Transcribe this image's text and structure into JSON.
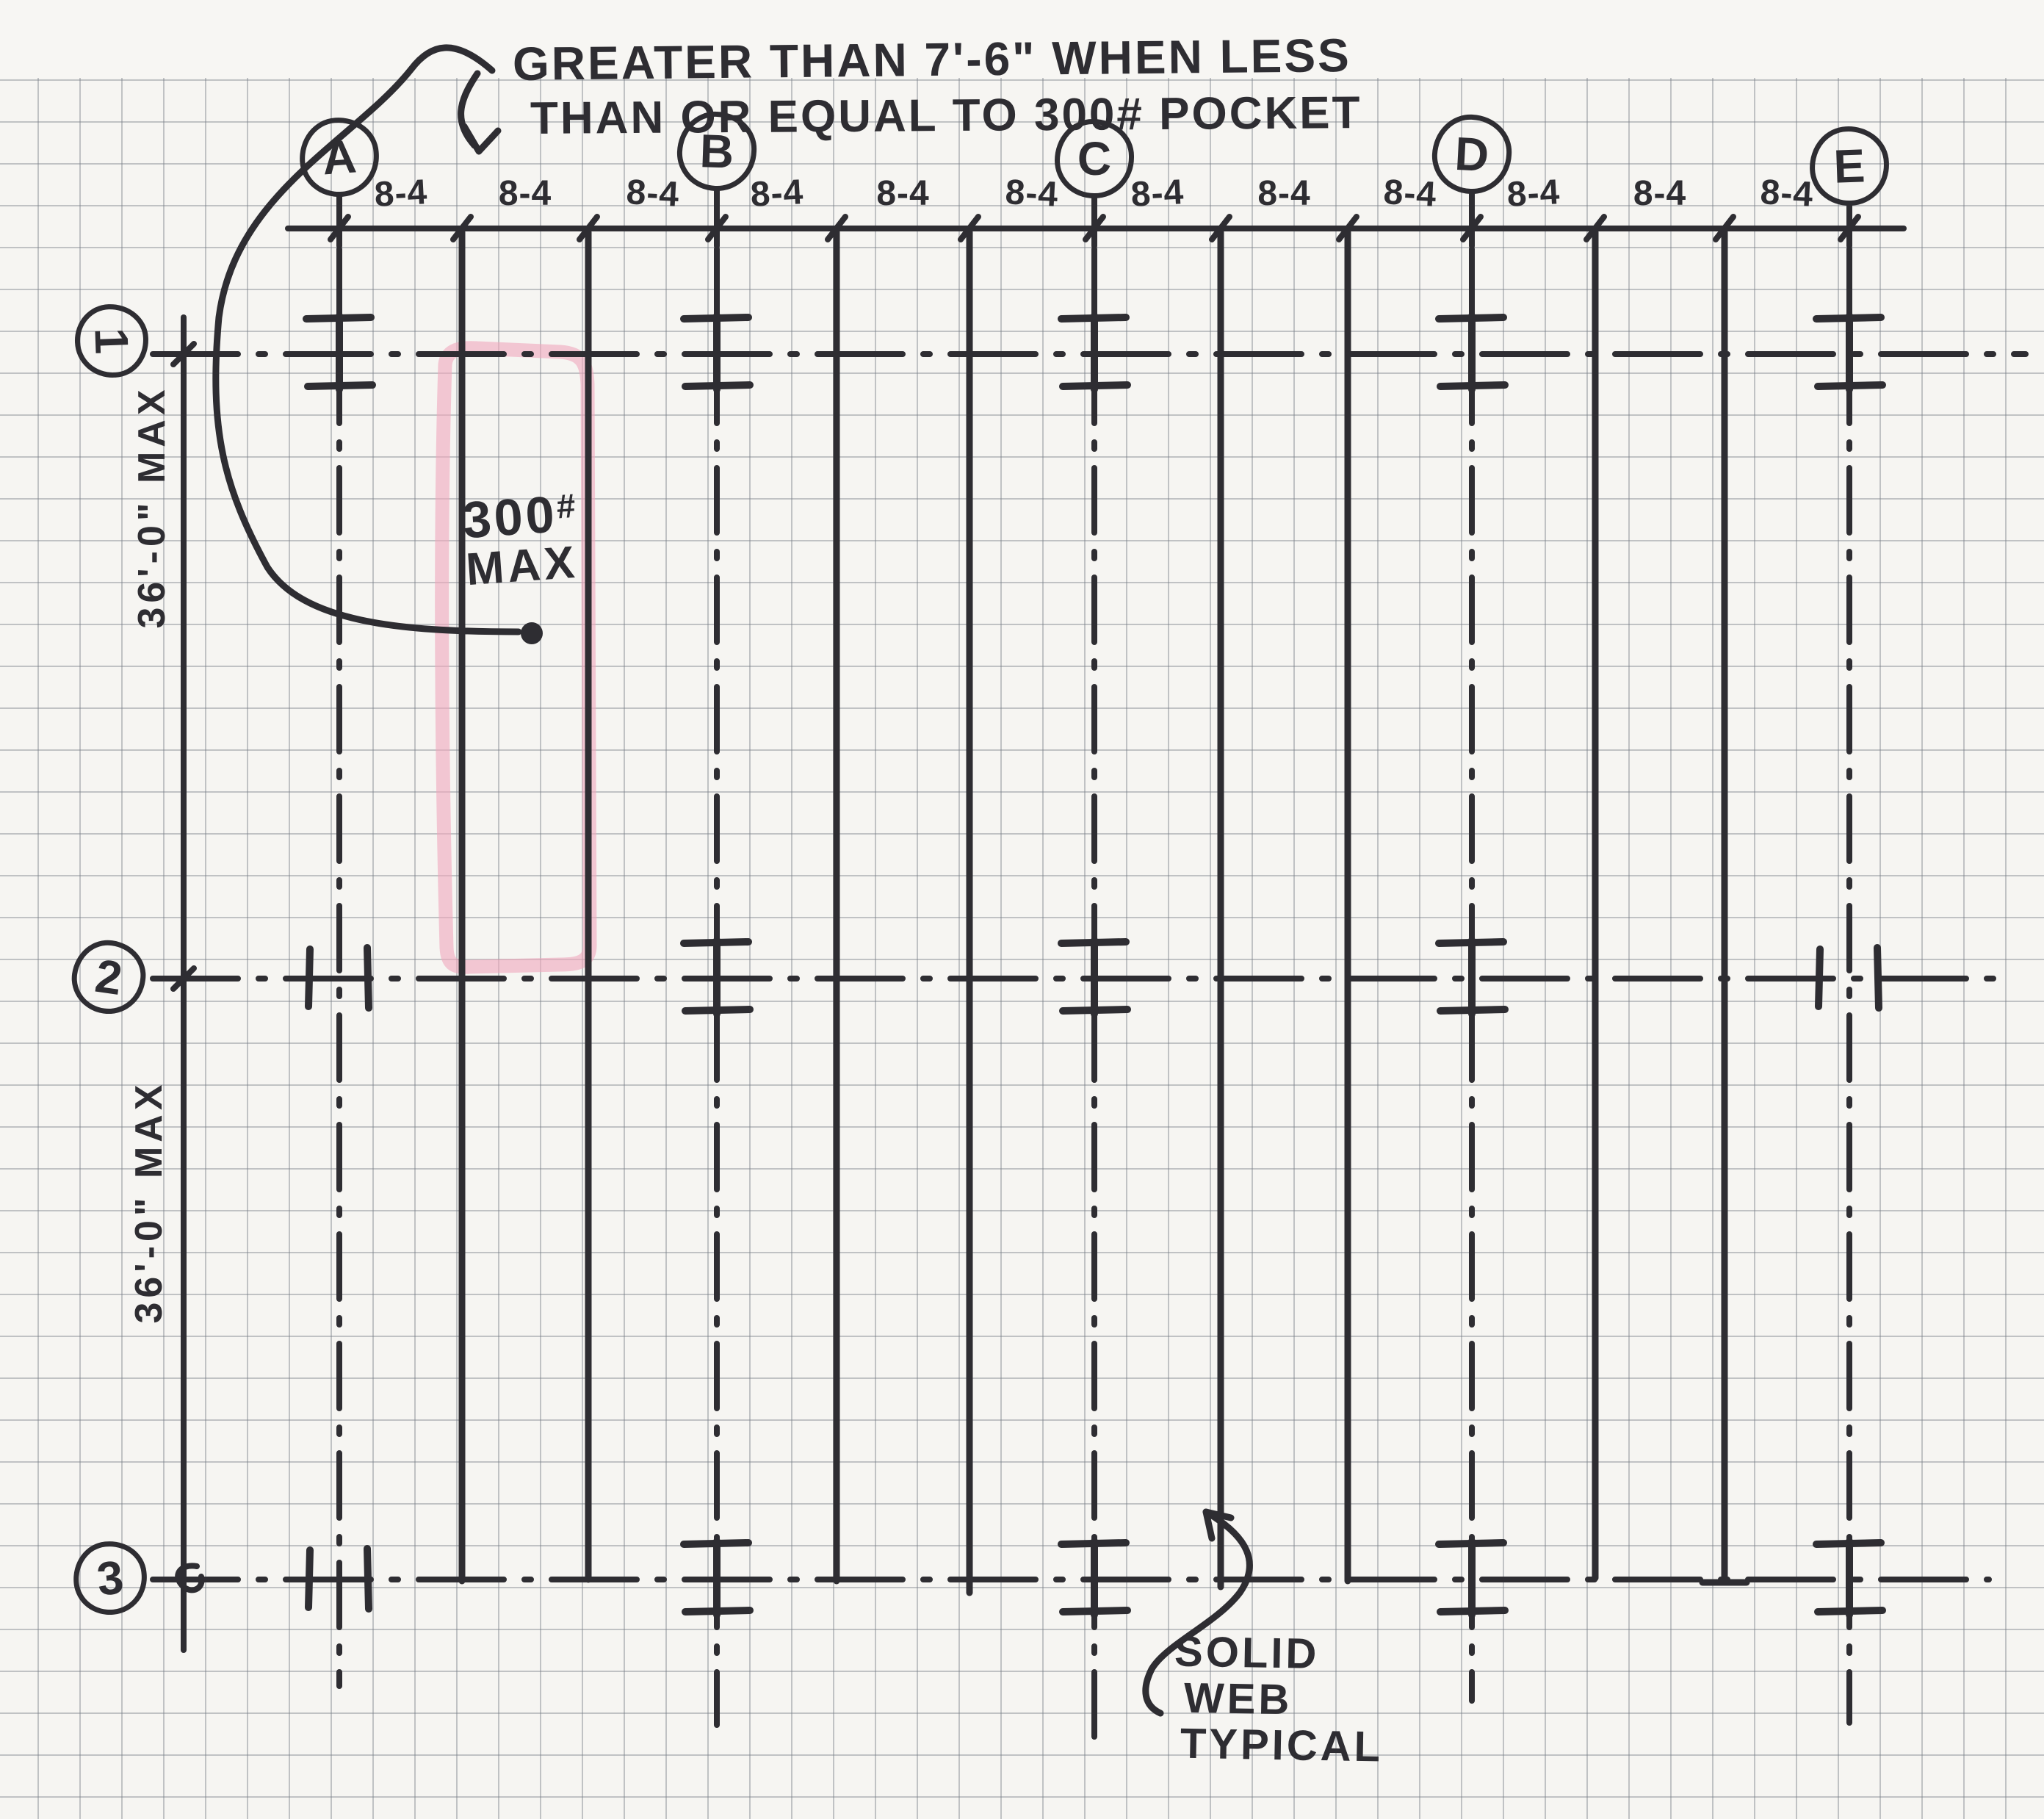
{
  "title_note": {
    "line1": "GREATER THAN 7'-6\" WHEN LESS",
    "line2": "THAN OR EQUAL TO 300# POCKET"
  },
  "column_grid": {
    "labels": [
      "A",
      "B",
      "C",
      "D",
      "E"
    ]
  },
  "row_grid": {
    "labels": [
      "1",
      "2",
      "3"
    ]
  },
  "top_dimension": {
    "spacing_labels": [
      "8-4",
      "8-4",
      "8-4",
      "8-4",
      "8-4",
      "8-4",
      "8-4",
      "8-4",
      "8-4",
      "8-4",
      "8-4",
      "8-4"
    ]
  },
  "left_dimension": {
    "span_labels": [
      "36'-0\" MAX",
      "36'-0\" MAX"
    ]
  },
  "pocket_callout": {
    "value": "300",
    "unit": "#",
    "suffix": "MAX"
  },
  "web_callout": {
    "lines": [
      "SOLID",
      "WEB",
      "TYPICAL"
    ]
  },
  "colors": {
    "ink": "#2e2d32",
    "highlight_pink": "#efa9bc",
    "paper": "#f6f5f2",
    "grid_line": "#767c85"
  }
}
